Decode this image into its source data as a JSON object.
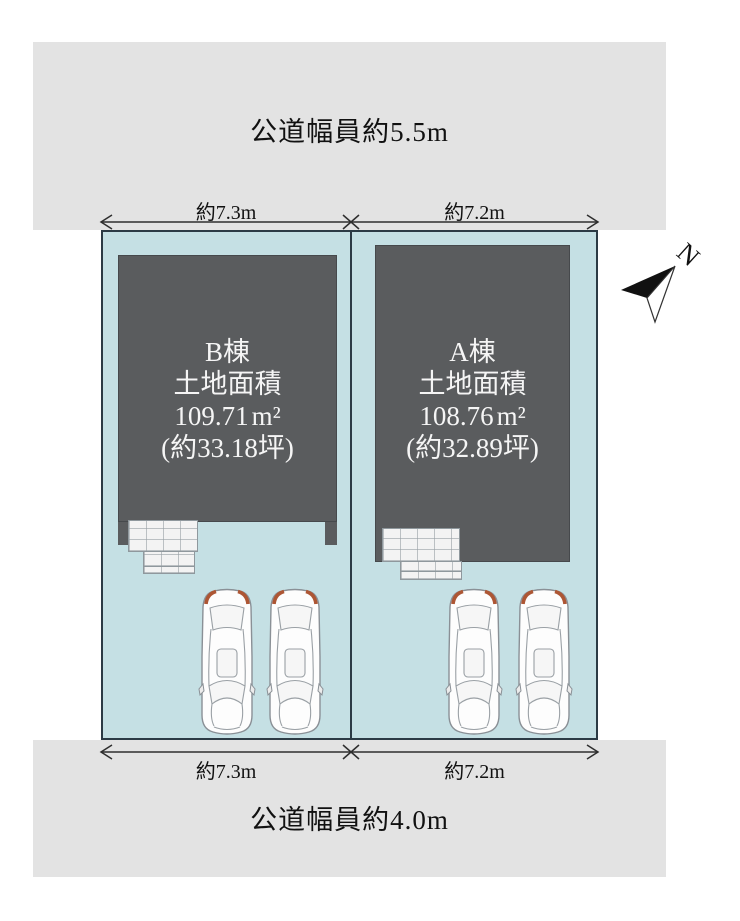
{
  "site_plan": {
    "roads": {
      "top": {
        "label": "公道幅員約5.5m"
      },
      "bottom": {
        "label": "公道幅員約4.0m"
      }
    },
    "dimensions": {
      "top": {
        "left": "約7.3m",
        "right": "約7.2m"
      },
      "bottom": {
        "left": "約7.3m",
        "right": "約7.2m"
      }
    },
    "lots": [
      {
        "id": "B",
        "building_name": "B棟",
        "area_caption": "土地面積",
        "area_value": "109.71",
        "area_unit": "m²",
        "area_tsubo": "(約33.18坪)"
      },
      {
        "id": "A",
        "building_name": "A棟",
        "area_caption": "土地面積",
        "area_value": "108.76",
        "area_unit": "m²",
        "area_tsubo": "(約32.89坪)"
      }
    ],
    "compass": {
      "label": "N"
    },
    "colors": {
      "road": "#e3e3e3",
      "lot_fill": "#c5e0e4",
      "lot_border": "#2c3b45",
      "building_fill": "#5a5c5e",
      "building_text": "#f5f5f5",
      "car_taillight": "#ad5634"
    }
  }
}
